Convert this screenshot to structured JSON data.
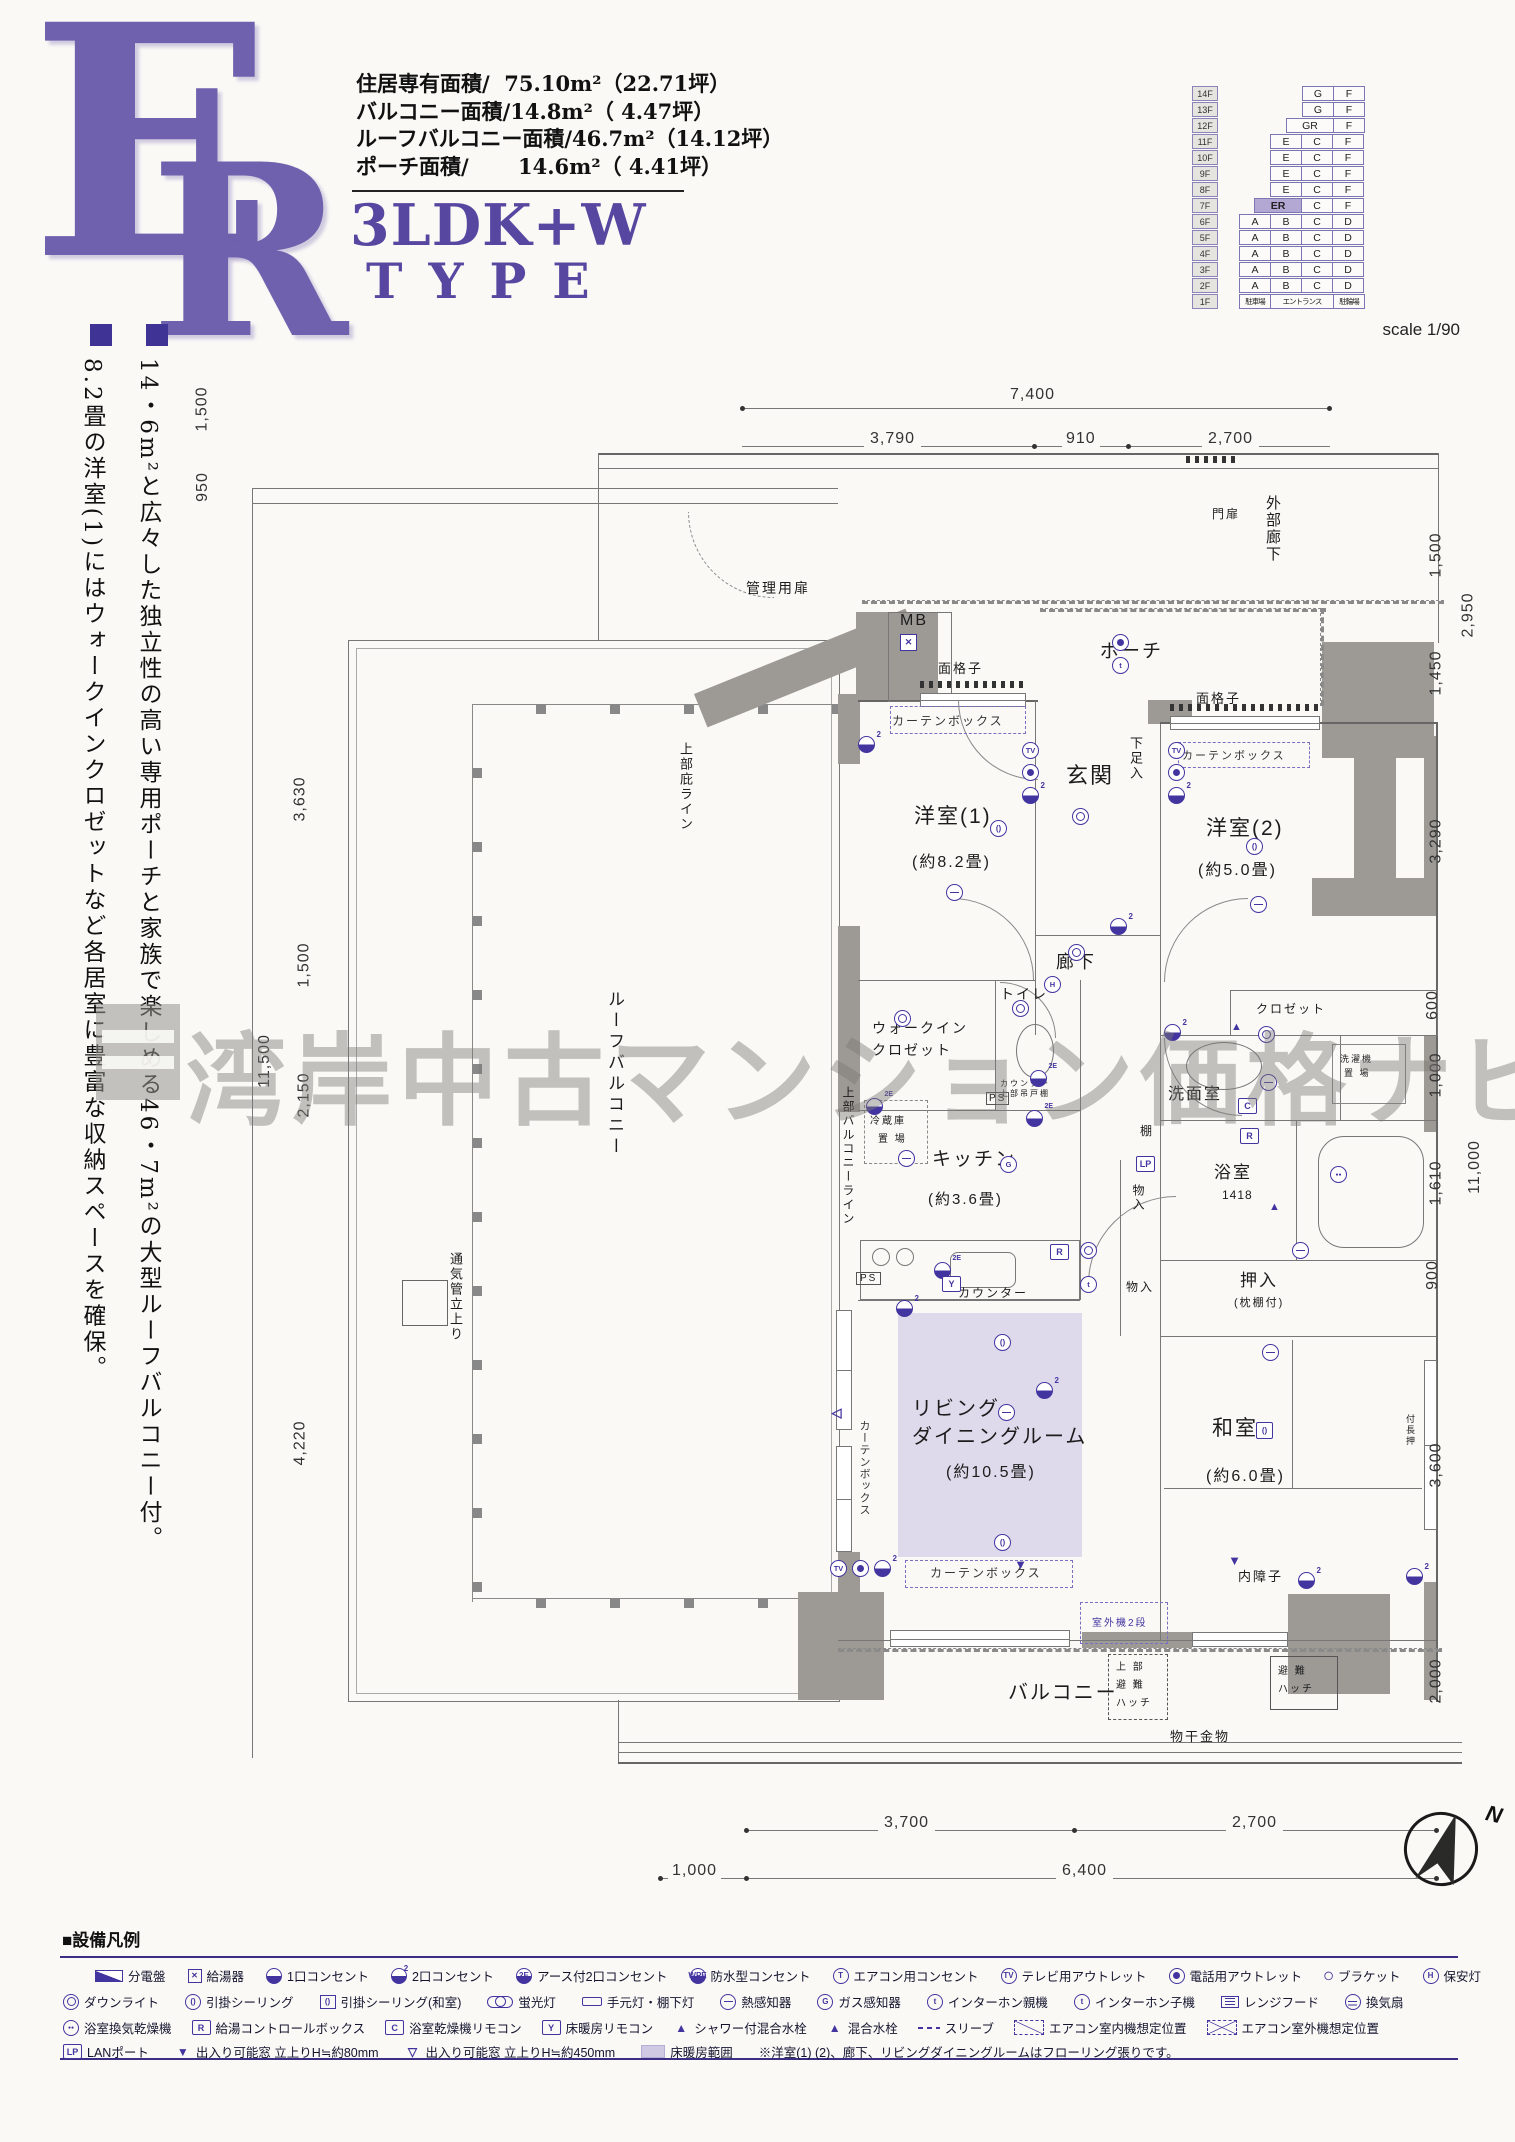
{
  "header": {
    "letter_e": "E",
    "letter_r": "R",
    "area_lines": "住居専有面積/  75.10m²（22.71坪）\nバルコニー面積/14.8m²（ 4.47坪）\nルーフバルコニー面積/46.7m²（14.12坪）\nポーチ面積/　　 14.6m²（ 4.41坪）",
    "plan_type": "3LDK+W",
    "type_word": "TYPE",
    "scale": "scale 1/90"
  },
  "building": {
    "floors": [
      {
        "f": "14F",
        "cells": [
          {
            "w": "2",
            "sp": "1"
          },
          {
            "t": "G",
            "w": "1"
          },
          {
            "t": "F",
            "w": "1"
          }
        ]
      },
      {
        "f": "13F",
        "cells": [
          {
            "w": "2",
            "sp": "1"
          },
          {
            "t": "G",
            "w": "1"
          },
          {
            "t": "F",
            "w": "1"
          }
        ]
      },
      {
        "f": "12F",
        "cells": [
          {
            "w": "1.5",
            "sp": "1"
          },
          {
            "t": "GR",
            "w": "1.5"
          },
          {
            "t": "F",
            "w": "1"
          }
        ]
      },
      {
        "f": "11F",
        "cells": [
          {
            "w": "1",
            "sp": "1"
          },
          {
            "t": "E",
            "w": "1"
          },
          {
            "t": "C",
            "w": "1"
          },
          {
            "t": "F",
            "w": "1"
          }
        ]
      },
      {
        "f": "10F",
        "cells": [
          {
            "w": "1",
            "sp": "1"
          },
          {
            "t": "E",
            "w": "1"
          },
          {
            "t": "C",
            "w": "1"
          },
          {
            "t": "F",
            "w": "1"
          }
        ]
      },
      {
        "f": "9F",
        "cells": [
          {
            "w": "1",
            "sp": "1"
          },
          {
            "t": "E",
            "w": "1"
          },
          {
            "t": "C",
            "w": "1"
          },
          {
            "t": "F",
            "w": "1"
          }
        ]
      },
      {
        "f": "8F",
        "cells": [
          {
            "w": "1",
            "sp": "1"
          },
          {
            "t": "E",
            "w": "1"
          },
          {
            "t": "C",
            "w": "1"
          },
          {
            "t": "F",
            "w": "1"
          }
        ]
      },
      {
        "f": "7F",
        "cells": [
          {
            "w": "0.5",
            "sp": "1"
          },
          {
            "t": "ER",
            "w": "1.5",
            "hl": "1"
          },
          {
            "t": "C",
            "w": "1"
          },
          {
            "t": "F",
            "w": "1"
          }
        ]
      },
      {
        "f": "6F",
        "cells": [
          {
            "t": "A",
            "w": "1"
          },
          {
            "t": "B",
            "w": "1"
          },
          {
            "t": "C",
            "w": "1"
          },
          {
            "t": "D",
            "w": "1"
          }
        ]
      },
      {
        "f": "5F",
        "cells": [
          {
            "t": "A",
            "w": "1"
          },
          {
            "t": "B",
            "w": "1"
          },
          {
            "t": "C",
            "w": "1"
          },
          {
            "t": "D",
            "w": "1"
          }
        ]
      },
      {
        "f": "4F",
        "cells": [
          {
            "t": "A",
            "w": "1"
          },
          {
            "t": "B",
            "w": "1"
          },
          {
            "t": "C",
            "w": "1"
          },
          {
            "t": "D",
            "w": "1"
          }
        ]
      },
      {
        "f": "3F",
        "cells": [
          {
            "t": "A",
            "w": "1"
          },
          {
            "t": "B",
            "w": "1"
          },
          {
            "t": "C",
            "w": "1"
          },
          {
            "t": "D",
            "w": "1"
          }
        ]
      },
      {
        "f": "2F",
        "cells": [
          {
            "t": "A",
            "w": "1"
          },
          {
            "t": "B",
            "w": "1"
          },
          {
            "t": "C",
            "w": "1"
          },
          {
            "t": "D",
            "w": "1"
          }
        ]
      },
      {
        "f": "1F",
        "cells": [
          {
            "t": "駐車場",
            "w": "1",
            "sm": "1"
          },
          {
            "t": "エントランス",
            "w": "2",
            "sm": "1"
          },
          {
            "t": "駐輪場",
            "w": "1",
            "sm": "1"
          }
        ]
      }
    ]
  },
  "intro": {
    "col1": "14・6m²と広々した独立性の高い専用ポーチと家族で楽しめる46・7m²の大型ルーフバルコニー付。",
    "col2": "8.2畳の洋室(1)にはウォークインクロゼットなど各居室に豊富な収納スペースを確保。"
  },
  "watermark": "湾岸中古マンション価格ナビ",
  "plan": {
    "labels": {
      "mb": "MB",
      "mensoshi": "面格子",
      "curtain": "カーテンボックス",
      "monpi": "門扉",
      "gaibu": "外部廊下",
      "kanri": "管理用扉",
      "poochi": "ポーチ",
      "genkan": "玄関",
      "shitasoku": "下足入",
      "yo1": "洋室(1)",
      "yo1s": "(約8.2畳)",
      "yo2": "洋室(2)",
      "yo2s": "(約5.0畳)",
      "rouka": "廊下",
      "wic1": "ウォークイン",
      "wic2": "クロゼット",
      "toilet": "トイレ",
      "counter_s": "カウンター",
      "tsuridana": "上部吊戸棚",
      "reizo1": "冷蔵庫",
      "reizo2": "置 場",
      "kitchen": "キッチン",
      "kitchens": "(約3.6畳)",
      "senmen": "洗面室",
      "sentaku1": "洗濯機",
      "sentaku2": "置 場",
      "closet": "クロゼット",
      "tana": "棚",
      "monoiri": "物入",
      "yoku": "浴室",
      "bath_size": "1418",
      "oshiire": "押入",
      "makura": "(枕棚付)",
      "living1": "リビング",
      "living2": "ダイニングルーム",
      "livings": "(約10.5畳)",
      "washitsu": "和室",
      "washitsus": "(約6.0畳)",
      "fuke": "付長押",
      "uchishoji": "内障子",
      "shitsugai": "室外機2段",
      "balcony": "バルコニー",
      "hin1": "上 部",
      "hin2": "避 難",
      "hin3": "ハッチ",
      "monohoshi": "物干金物",
      "roofbal": "ルーフバルコニー",
      "hisashi": "上部庇ライン",
      "balline": "上部バルコニーライン",
      "tsuuki": "通気管立上り",
      "ps": "PS"
    },
    "dims": {
      "top": [
        "7,400",
        "3,790",
        "910",
        "2,700"
      ],
      "bottom": [
        "3,700",
        "2,700",
        "1,000",
        "6,400"
      ],
      "left": [
        "1,500",
        "950",
        "3,630",
        "1,500",
        "11,500",
        "2,150",
        "4,220"
      ],
      "right": [
        "1,500",
        "2,950",
        "1,450",
        "3,290",
        "600",
        "1,000",
        "11,000",
        "1,610",
        "900",
        "3,600",
        "2,000"
      ]
    },
    "symbols": [
      {
        "k": "o2",
        "x": 858,
        "y": 736
      },
      {
        "k": "kyuto",
        "x": 900,
        "y": 634,
        "t": "✕"
      },
      {
        "k": "tv",
        "x": 1022,
        "y": 742,
        "t": "TV"
      },
      {
        "k": "tel",
        "x": 1022,
        "y": 764
      },
      {
        "k": "o2",
        "x": 1022,
        "y": 787
      },
      {
        "k": "cl",
        "x": 990,
        "y": 820,
        "t": "()"
      },
      {
        "k": "ho",
        "x": 946,
        "y": 884
      },
      {
        "k": "dl",
        "x": 1072,
        "y": 808
      },
      {
        "k": "dl",
        "x": 1068,
        "y": 944
      },
      {
        "k": "o2",
        "x": 1110,
        "y": 918
      },
      {
        "k": "tel",
        "x": 1112,
        "y": 634
      },
      {
        "k": "int1",
        "x": 1112,
        "y": 657,
        "t": "t"
      },
      {
        "k": "tv",
        "x": 1168,
        "y": 742,
        "t": "TV"
      },
      {
        "k": "tel",
        "x": 1168,
        "y": 764
      },
      {
        "k": "o2",
        "x": 1168,
        "y": 787
      },
      {
        "k": "cl",
        "x": 1246,
        "y": 838,
        "t": "()"
      },
      {
        "k": "ho",
        "x": 1250,
        "y": 896
      },
      {
        "k": "hoan",
        "x": 1044,
        "y": 976,
        "t": "H"
      },
      {
        "k": "dl",
        "x": 1012,
        "y": 1000
      },
      {
        "k": "o2e",
        "x": 1030,
        "y": 1070
      },
      {
        "k": "dl",
        "x": 894,
        "y": 1010
      },
      {
        "k": "o2e",
        "x": 866,
        "y": 1098
      },
      {
        "k": "o2e",
        "x": 1026,
        "y": 1110
      },
      {
        "k": "gas",
        "x": 1000,
        "y": 1156,
        "t": "G"
      },
      {
        "k": "ho",
        "x": 898,
        "y": 1150
      },
      {
        "k": "o2e",
        "x": 934,
        "y": 1262
      },
      {
        "k": "boxR",
        "x": 1050,
        "y": 1244,
        "t": "R"
      },
      {
        "k": "boxY",
        "x": 942,
        "y": 1276,
        "t": "Y"
      },
      {
        "k": "dl",
        "x": 1080,
        "y": 1242
      },
      {
        "k": "int2",
        "x": 1080,
        "y": 1276,
        "t": "t"
      },
      {
        "k": "o2",
        "x": 1164,
        "y": 1024
      },
      {
        "k": "mix",
        "x": 1228,
        "y": 1018,
        "t": "▲"
      },
      {
        "k": "dl",
        "x": 1258,
        "y": 1026
      },
      {
        "k": "ho",
        "x": 1260,
        "y": 1074
      },
      {
        "k": "boxC",
        "x": 1238,
        "y": 1098,
        "t": "C"
      },
      {
        "k": "boxR",
        "x": 1240,
        "y": 1128,
        "t": "R"
      },
      {
        "k": "boxLP",
        "x": 1136,
        "y": 1156,
        "t": "LP"
      },
      {
        "k": "bath",
        "x": 1330,
        "y": 1166,
        "t": "●●"
      },
      {
        "k": "mix",
        "x": 1266,
        "y": 1198,
        "t": "▲"
      },
      {
        "k": "ho",
        "x": 1292,
        "y": 1242
      },
      {
        "k": "o2",
        "x": 896,
        "y": 1300
      },
      {
        "k": "o2",
        "x": 1036,
        "y": 1382
      },
      {
        "k": "cl",
        "x": 994,
        "y": 1334,
        "t": "()"
      },
      {
        "k": "ho",
        "x": 998,
        "y": 1404
      },
      {
        "k": "cl",
        "x": 994,
        "y": 1534,
        "t": "()"
      },
      {
        "k": "lt",
        "x": 828,
        "y": 1404,
        "t": "◁"
      },
      {
        "k": "ho",
        "x": 1262,
        "y": 1344
      },
      {
        "k": "clb",
        "x": 1256,
        "y": 1422,
        "t": "()"
      },
      {
        "k": "tv",
        "x": 830,
        "y": 1560,
        "t": "TV"
      },
      {
        "k": "tel",
        "x": 852,
        "y": 1560
      },
      {
        "k": "o2",
        "x": 874,
        "y": 1560
      },
      {
        "k": "tri",
        "x": 1012,
        "y": 1556,
        "t": "▼"
      },
      {
        "k": "tri",
        "x": 1226,
        "y": 1552,
        "t": "▼"
      },
      {
        "k": "o2",
        "x": 1298,
        "y": 1572
      },
      {
        "k": "o2",
        "x": 1406,
        "y": 1568
      }
    ]
  },
  "compass": {
    "n": "N"
  },
  "legend": {
    "title": "■設備凡例",
    "row1": [
      {
        "icon": "bunden",
        "label": "分電盤"
      },
      {
        "icon": "kyuto",
        "ic_t": "✕",
        "label": "給湯器"
      },
      {
        "icon": "out1",
        "label": "1口コンセント"
      },
      {
        "icon": "out2",
        "label": "2口コンセント"
      },
      {
        "icon": "out2e",
        "ic_t": "2E",
        "label": "アース付2口コンセント"
      },
      {
        "icon": "wpe",
        "ic_t": "WPE",
        "label": "防水型コンセント"
      },
      {
        "icon": "ac",
        "ic_t": "T",
        "label": "エアコン用コンセント"
      },
      {
        "icon": "tvout",
        "ic_t": "TV",
        "label": "テレビ用アウトレット"
      },
      {
        "icon": "telout",
        "label": "電話用アウトレット"
      },
      {
        "icon": "bracket",
        "ic_t": "◯",
        "label": "ブラケット"
      },
      {
        "icon": "hoan",
        "ic_t": "H",
        "label": "保安灯"
      }
    ],
    "row2": [
      {
        "icon": "downlight",
        "label": "ダウンライト"
      },
      {
        "icon": "hikkake",
        "ic_t": "()",
        "label": "引掛シーリング"
      },
      {
        "icon": "hikkake2",
        "ic_t": "()",
        "label": "引掛シーリング(和室)"
      },
      {
        "icon": "keikou",
        "label": "蛍光灯"
      },
      {
        "icon": "temoto",
        "label": "手元灯・棚下灯"
      },
      {
        "icon": "netsu",
        "label": "熱感知器"
      },
      {
        "icon": "gas",
        "ic_t": "G",
        "label": "ガス感知器"
      },
      {
        "icon": "int1",
        "ic_t": "t",
        "label": "インターホン親機"
      },
      {
        "icon": "int2",
        "ic_t": "t",
        "label": "インターホン子機"
      },
      {
        "icon": "range",
        "label": "レンジフード"
      },
      {
        "icon": "fan",
        "label": "換気扇"
      }
    ],
    "row3": [
      {
        "icon": "yokukan",
        "ic_t": "●●",
        "label": "浴室換気乾燥機"
      },
      {
        "icon": "boxR",
        "ic_t": "R",
        "label": "給湯コントロールボックス"
      },
      {
        "icon": "boxC",
        "ic_t": "C",
        "label": "浴室乾燥機リモコン"
      },
      {
        "icon": "boxY",
        "ic_t": "Y",
        "label": "床暖房リモコン"
      },
      {
        "icon": "shower",
        "ic_t": "▲",
        "label": "シャワー付混合水栓"
      },
      {
        "icon": "mixer",
        "ic_t": "▲",
        "label": "混合水栓"
      },
      {
        "icon": "sleeve",
        "label": "スリーブ"
      },
      {
        "icon": "acin",
        "label": "エアコン室内機想定位置"
      },
      {
        "icon": "acout",
        "label": "エアコン室外機想定位置"
      }
    ],
    "row4": [
      {
        "icon": "boxLP",
        "ic_t": "LP",
        "label": "LANポート"
      },
      {
        "icon": "tri80",
        "ic_t": "▼",
        "label": "出入り可能窓 立上りH≒約80mm"
      },
      {
        "icon": "tri450",
        "ic_t": "▽",
        "label": "出入り可能窓 立上りH≒約450mm"
      },
      {
        "icon": "yuka",
        "label": "床暖房範囲"
      },
      {
        "icon": "none",
        "label": "※洋室(1) (2)、廊下、リビングダイニングルームはフローリング張りです。"
      }
    ]
  }
}
